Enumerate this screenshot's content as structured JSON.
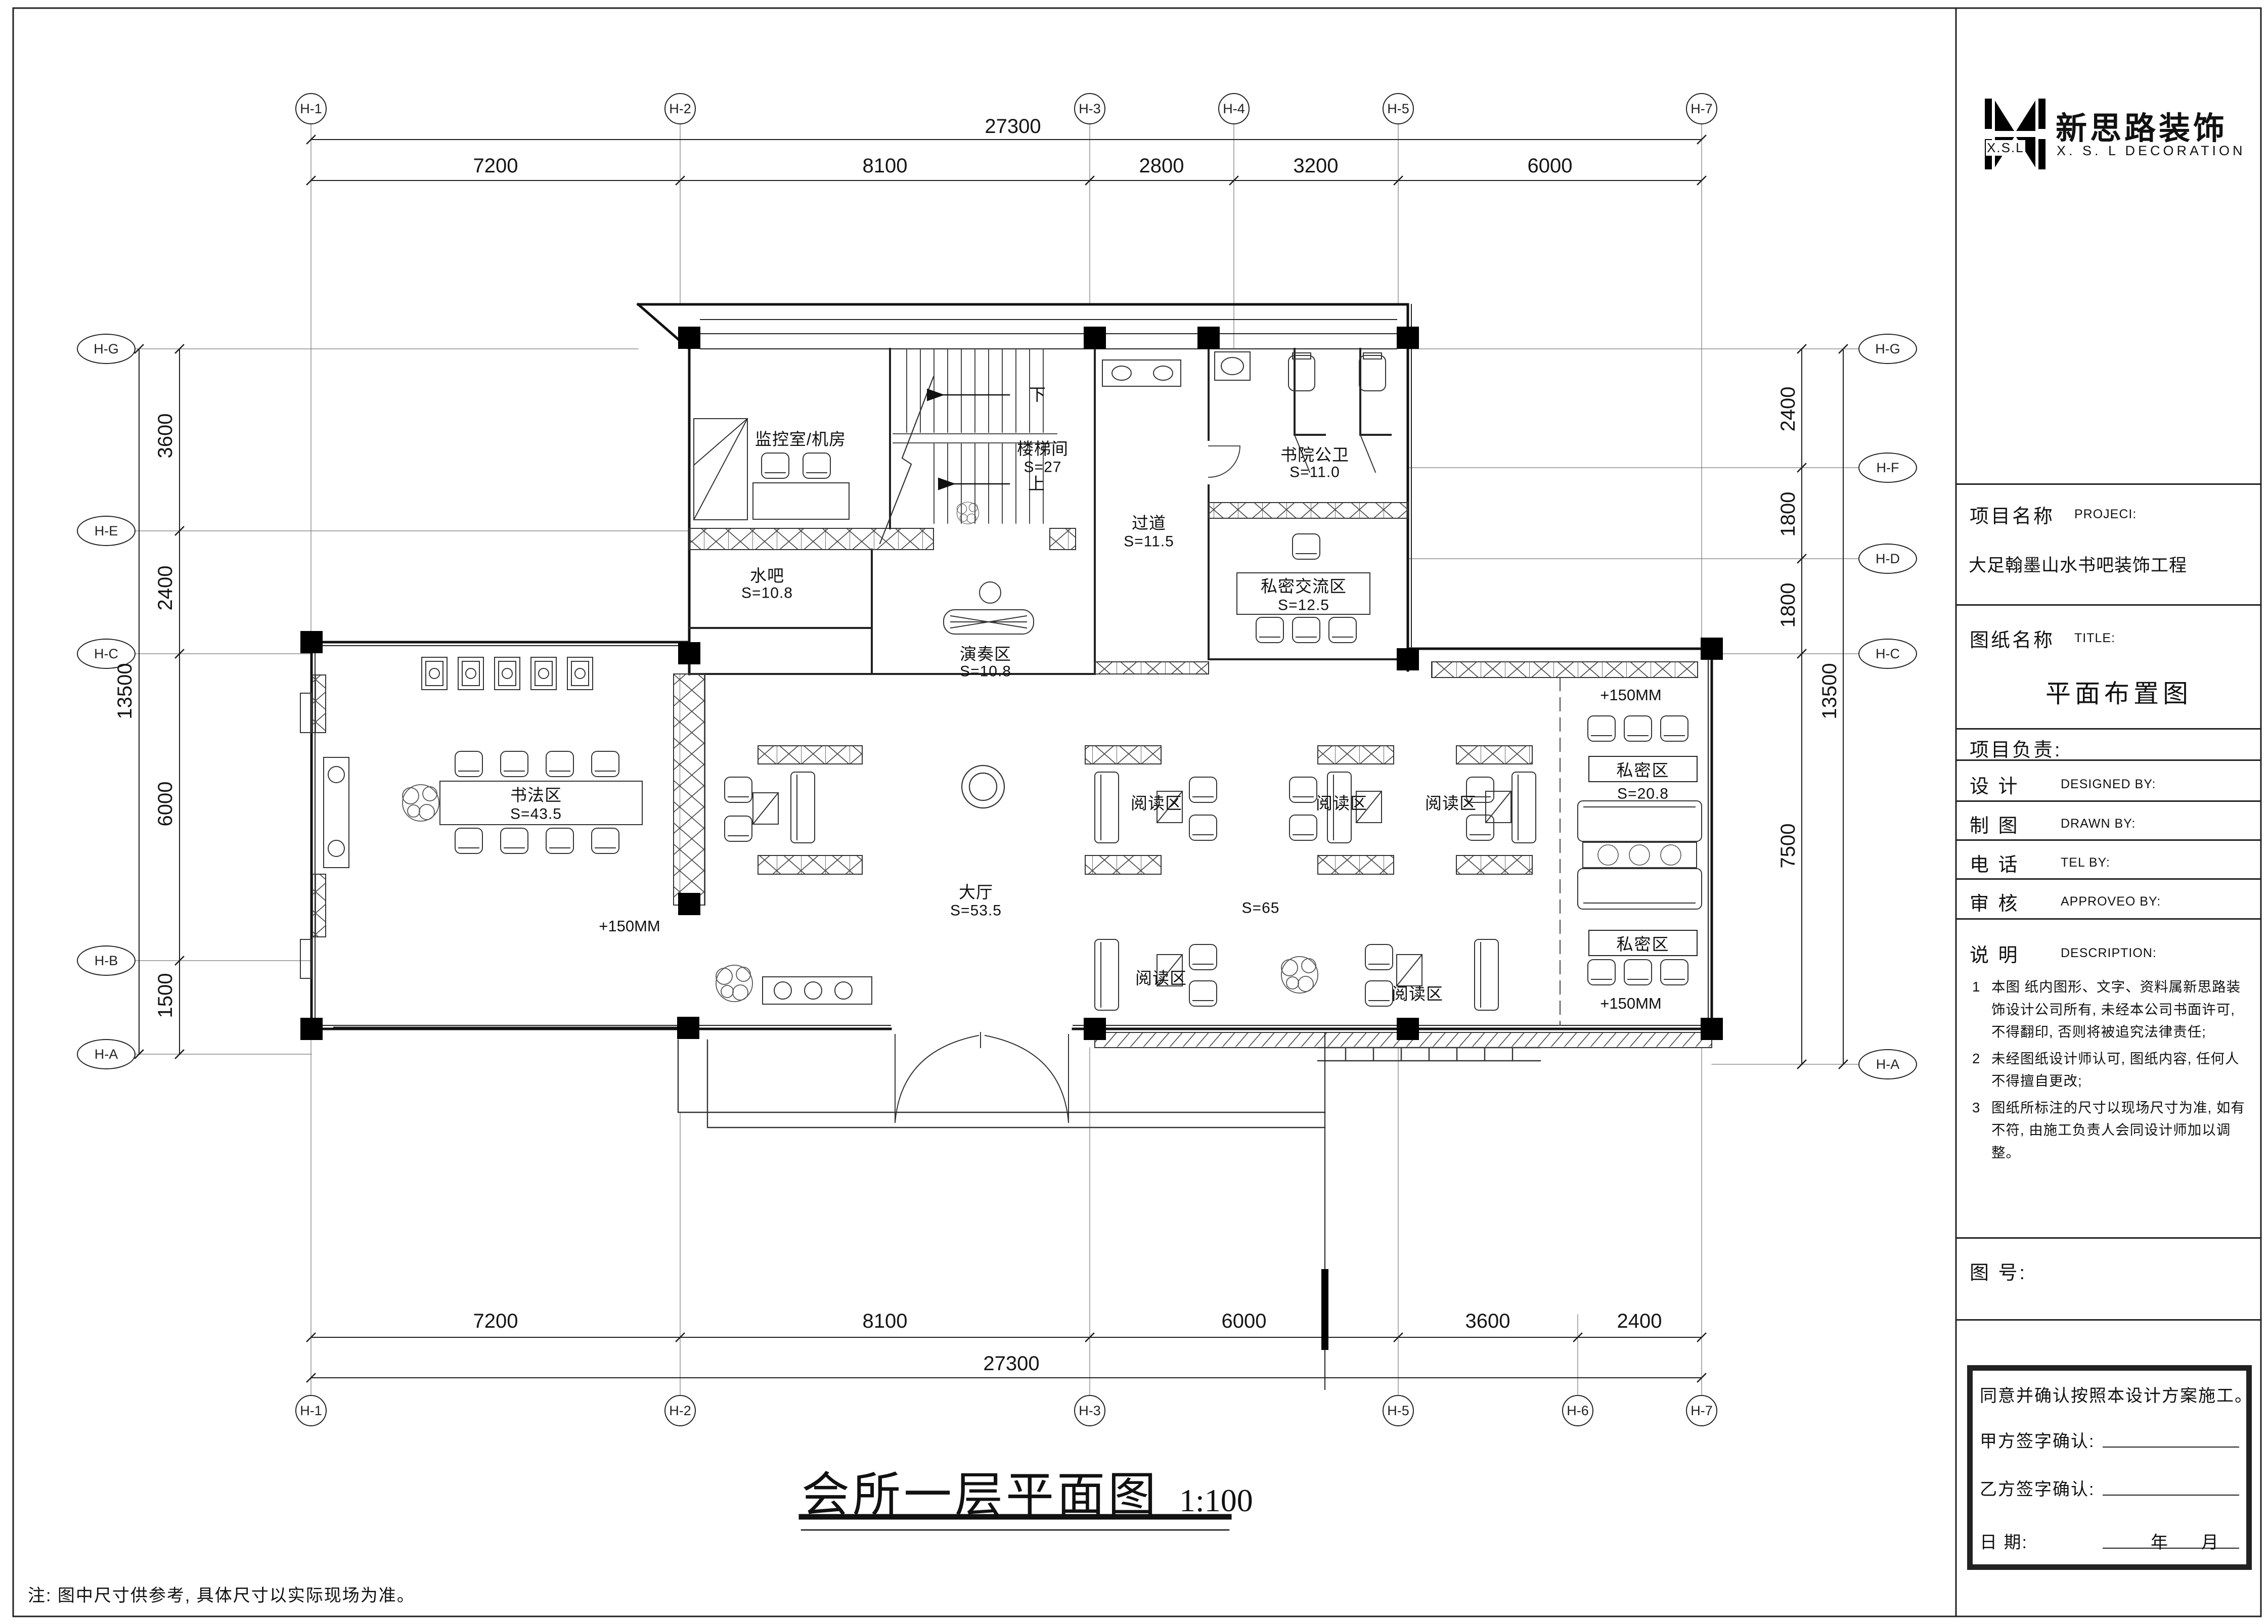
{
  "logo": {
    "xsl": "X.S.L",
    "cn": "新思路装饰",
    "en": "X. S. L  DECORATION"
  },
  "title_block": {
    "project_label": "项目名称",
    "project_label_en": "PROJECI:",
    "project_name": "大足翰墨山水书吧装饰工程",
    "sheet_label": "图纸名称",
    "sheet_label_en": "TITLE:",
    "sheet_name": "平面布置图",
    "leader_label": "项目负责:",
    "design_cn": "设  计",
    "design_en": "DESIGNED BY:",
    "draw_cn": "制  图",
    "draw_en": "DRAWN BY:",
    "tel_cn": "电  话",
    "tel_en": "TEL BY:",
    "approve_cn": "审  核",
    "approve_en": "APPROVEO BY:",
    "desc_cn": "说  明",
    "desc_en": "DESCRIPTION:",
    "notes": [
      {
        "num": "1",
        "text": "本图 纸内图形、文字、资料属新思路装饰设计公司所有, 未经本公司书面许可, 不得翻印, 否则将被追究法律责任;"
      },
      {
        "num": "2",
        "text": "未经图纸设计师认可, 图纸内容, 任何人不得擅自更改;"
      },
      {
        "num": "3",
        "text": "图纸所标注的尺寸以现场尺寸为准, 如有不符, 由施工负责人会同设计师加以调整。"
      }
    ],
    "drawing_no_label": "图  号:",
    "signature": {
      "agree": "同意并确认按照本设计方案施工。",
      "party_a": "甲方签字确认:",
      "party_b": "乙方签字确认:",
      "date_label": "日        期:",
      "year": "年",
      "month": "月"
    }
  },
  "grid": {
    "top": [
      "H-1",
      "H-2",
      "H-3",
      "H-4",
      "H-5",
      "H-7"
    ],
    "bottom": [
      "H-1",
      "H-2",
      "H-3",
      "H-5",
      "H-6",
      "H-7"
    ],
    "left": [
      "H-G",
      "H-E",
      "H-C",
      "H-B",
      "H-A"
    ],
    "right": [
      "H-G",
      "H-F",
      "H-D",
      "H-C",
      "H-A"
    ]
  },
  "dimensions": {
    "top_total": "27300",
    "top": [
      "7200",
      "8100",
      "2800",
      "3200",
      "6000"
    ],
    "bottom": [
      "7200",
      "8100",
      "6000",
      "3600",
      "2400"
    ],
    "bottom_total": "27300",
    "left_total": "13500",
    "left": [
      "3600",
      "2400",
      "6000",
      "1500"
    ],
    "right_total": "13500",
    "right": [
      "2400",
      "1800",
      "1800",
      "7500"
    ]
  },
  "rooms": {
    "monitor": {
      "name": "监控室/机房"
    },
    "stair": {
      "name": "楼梯间",
      "area": "S=27",
      "down": "下",
      "up": "上"
    },
    "corridor": {
      "name": "过道",
      "area": "S=11.5"
    },
    "toilet": {
      "name": "书院公卫",
      "area": "S=11.0"
    },
    "private_talk": {
      "name": "私密交流区",
      "area": "S=12.5"
    },
    "waterbar": {
      "name": "水吧",
      "area": "S=10.8"
    },
    "perform": {
      "name": "演奏区",
      "area": "S=10.8"
    },
    "calligraphy": {
      "name": "书法区",
      "area": "S=43.5"
    },
    "hall": {
      "name": "大厅",
      "area": "S=53.5"
    },
    "reading_total": {
      "area": "S=65"
    },
    "reading": {
      "name": "阅读区"
    },
    "private1": {
      "name": "私密区",
      "area": "S=20.8"
    },
    "private2": {
      "name": "私密区"
    },
    "elev": {
      "name": "+150MM"
    }
  },
  "drawing_title": {
    "text": "会所一层平面图",
    "scale": "1:100"
  },
  "footnote": "注: 图中尺寸供参考, 具体尺寸以实际现场为准。"
}
